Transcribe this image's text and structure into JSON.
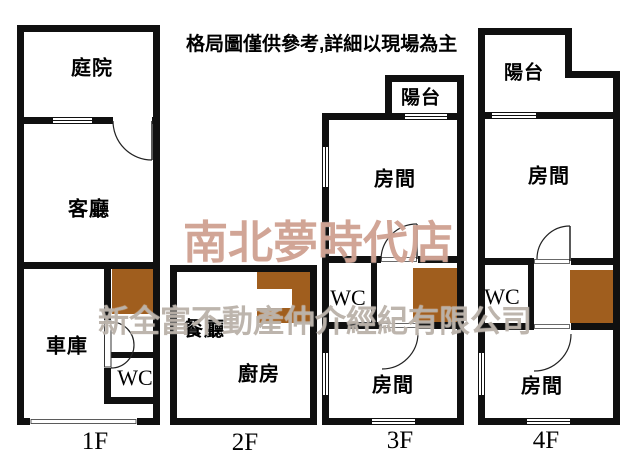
{
  "header": {
    "disclaimer": "格局圖僅供參考,詳細以現場為主"
  },
  "watermarks": {
    "store_name": "南北夢時代店",
    "company_name": "新全富不動產仲介經紀有限公司"
  },
  "colors": {
    "wall": "#101010",
    "stairs": "#a05e1e",
    "store_watermark": "#c58f7c",
    "company_watermark": "#aaa096"
  },
  "floors": {
    "f1": {
      "label": "1F",
      "rooms": {
        "courtyard": "庭院",
        "living_room": "客廳",
        "garage": "車庫",
        "wc": "WC"
      }
    },
    "f2": {
      "label": "2F",
      "rooms": {
        "dining_room": "餐廳",
        "kitchen": "廚房"
      }
    },
    "f3": {
      "label": "3F",
      "rooms": {
        "balcony": "陽台",
        "room_upper": "房間",
        "wc": "WC",
        "room_lower": "房間"
      }
    },
    "f4": {
      "label": "4F",
      "rooms": {
        "balcony": "陽台",
        "room_upper": "房間",
        "wc": "WC",
        "room_lower": "房間"
      }
    }
  }
}
